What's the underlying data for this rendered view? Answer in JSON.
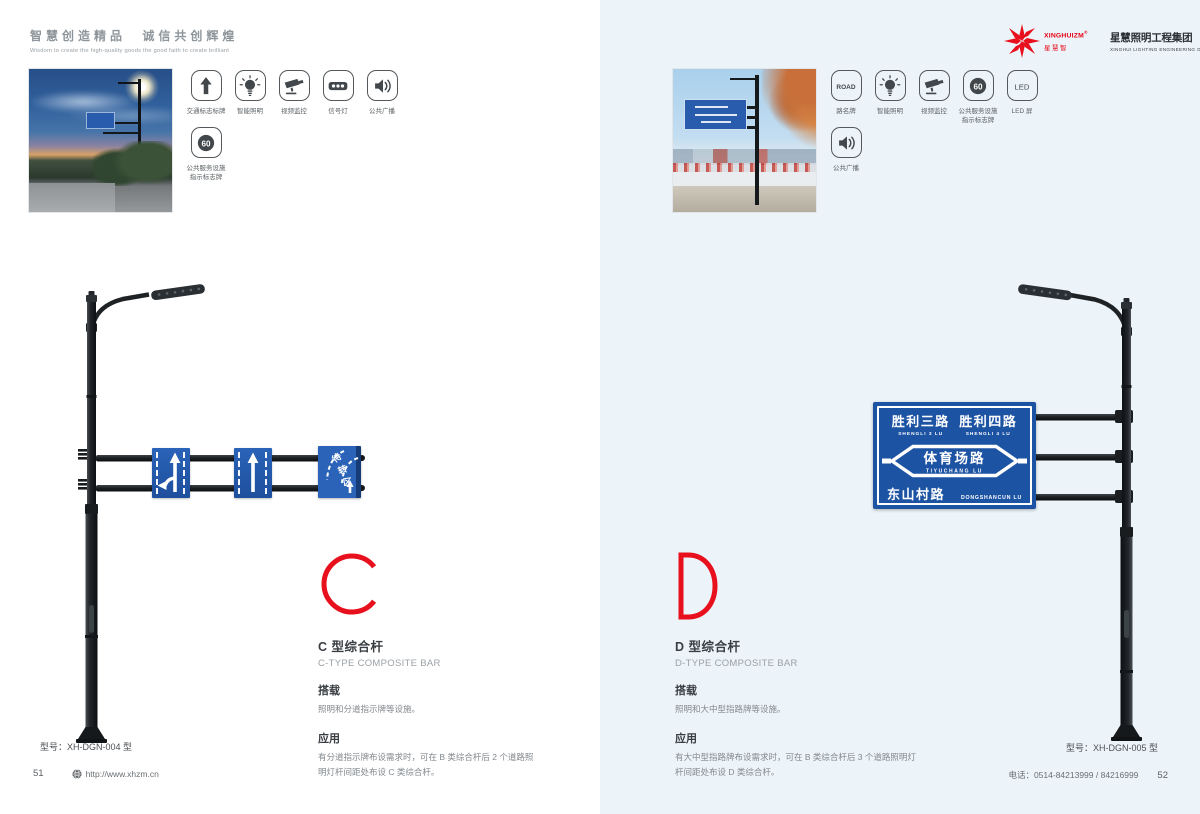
{
  "colors": {
    "accent_red": "#e8101d",
    "sign_blue": "#1d53a3",
    "right_page_bg": "#ecf4f9",
    "pole_dark": "#1e2225"
  },
  "header": {
    "slogan_cn": "智慧创造精品 诚信共创辉煌",
    "slogan_en": "Wisdom to create the high-quality goods the good faith to create brilliant",
    "logo": {
      "brand_en": "XINGHUIZM",
      "brand_reg": "®",
      "brand_cn": "星慧智",
      "company_cn": "星慧照明工程集团",
      "company_en": "XINGHUI LIGHTING ENGINEERING GROUP"
    }
  },
  "left_page": {
    "features_row1": [
      {
        "icon": "arrow-up",
        "label": "交通标志标牌"
      },
      {
        "icon": "bulb",
        "label": "智能照明"
      },
      {
        "icon": "camera",
        "label": "视频监控"
      },
      {
        "icon": "signal",
        "label": "信号灯"
      },
      {
        "icon": "speaker",
        "label": "公共广播"
      }
    ],
    "features_row2": [
      {
        "icon": "badge-60",
        "badge": "60",
        "label": "公共服务设施",
        "label2": "指示标志牌"
      }
    ],
    "sign3_chars": [
      "待",
      "转",
      "区"
    ],
    "letter": "C",
    "title_cn": "C 型综合杆",
    "title_en": "C-TYPE COMPOSITE BAR",
    "spec1_heading": "搭载",
    "spec1_text": "照明和分道指示牌等设施。",
    "spec2_heading": "应用",
    "spec2_text": "有分道指示牌布设需求时，可在 B 类综合杆后 2 个道路照明灯杆间距处布设 C 类综合杆。",
    "model": "型号：XH-DGN-004 型"
  },
  "right_page": {
    "features_row1": [
      {
        "icon": "badge-road",
        "badge": "ROAD",
        "label": "路名牌"
      },
      {
        "icon": "bulb",
        "label": "智能照明"
      },
      {
        "icon": "camera",
        "label": "视频监控"
      },
      {
        "icon": "badge-60",
        "badge": "60",
        "label": "公共服务设施",
        "label2": "指示标志牌"
      },
      {
        "icon": "badge-led",
        "badge": "LED",
        "label": "LED 屏"
      }
    ],
    "features_row2": [
      {
        "icon": "speaker",
        "label": "公共广播"
      }
    ],
    "road_sign": {
      "row1_left_cn": "胜利三路",
      "row1_left_en": "SHENGLI 3 LU",
      "row1_right_cn": "胜利四路",
      "row1_right_en": "SHENGLI 4 LU",
      "mid_cn": "体育场路",
      "mid_en": "TIYUCHANG LU",
      "row3_cn": "东山村路",
      "row3_en": "DONGSHANCUN LU"
    },
    "letter": "D",
    "title_cn": "D 型综合杆",
    "title_en": "D-TYPE COMPOSITE BAR",
    "spec1_heading": "搭载",
    "spec1_text": "照明和大中型指路牌等设施。",
    "spec2_heading": "应用",
    "spec2_text": "有大中型指路牌布设需求时，可在 B 类综合杆后 3 个道路照明灯杆间距处布设 D 类综合杆。",
    "model": "型号：XH-DGN-005 型"
  },
  "footer": {
    "left_page_number": "51",
    "website": "http://www.xhzm.cn",
    "phone": "电话：0514-84213999 / 84216999",
    "right_page_number": "52"
  }
}
